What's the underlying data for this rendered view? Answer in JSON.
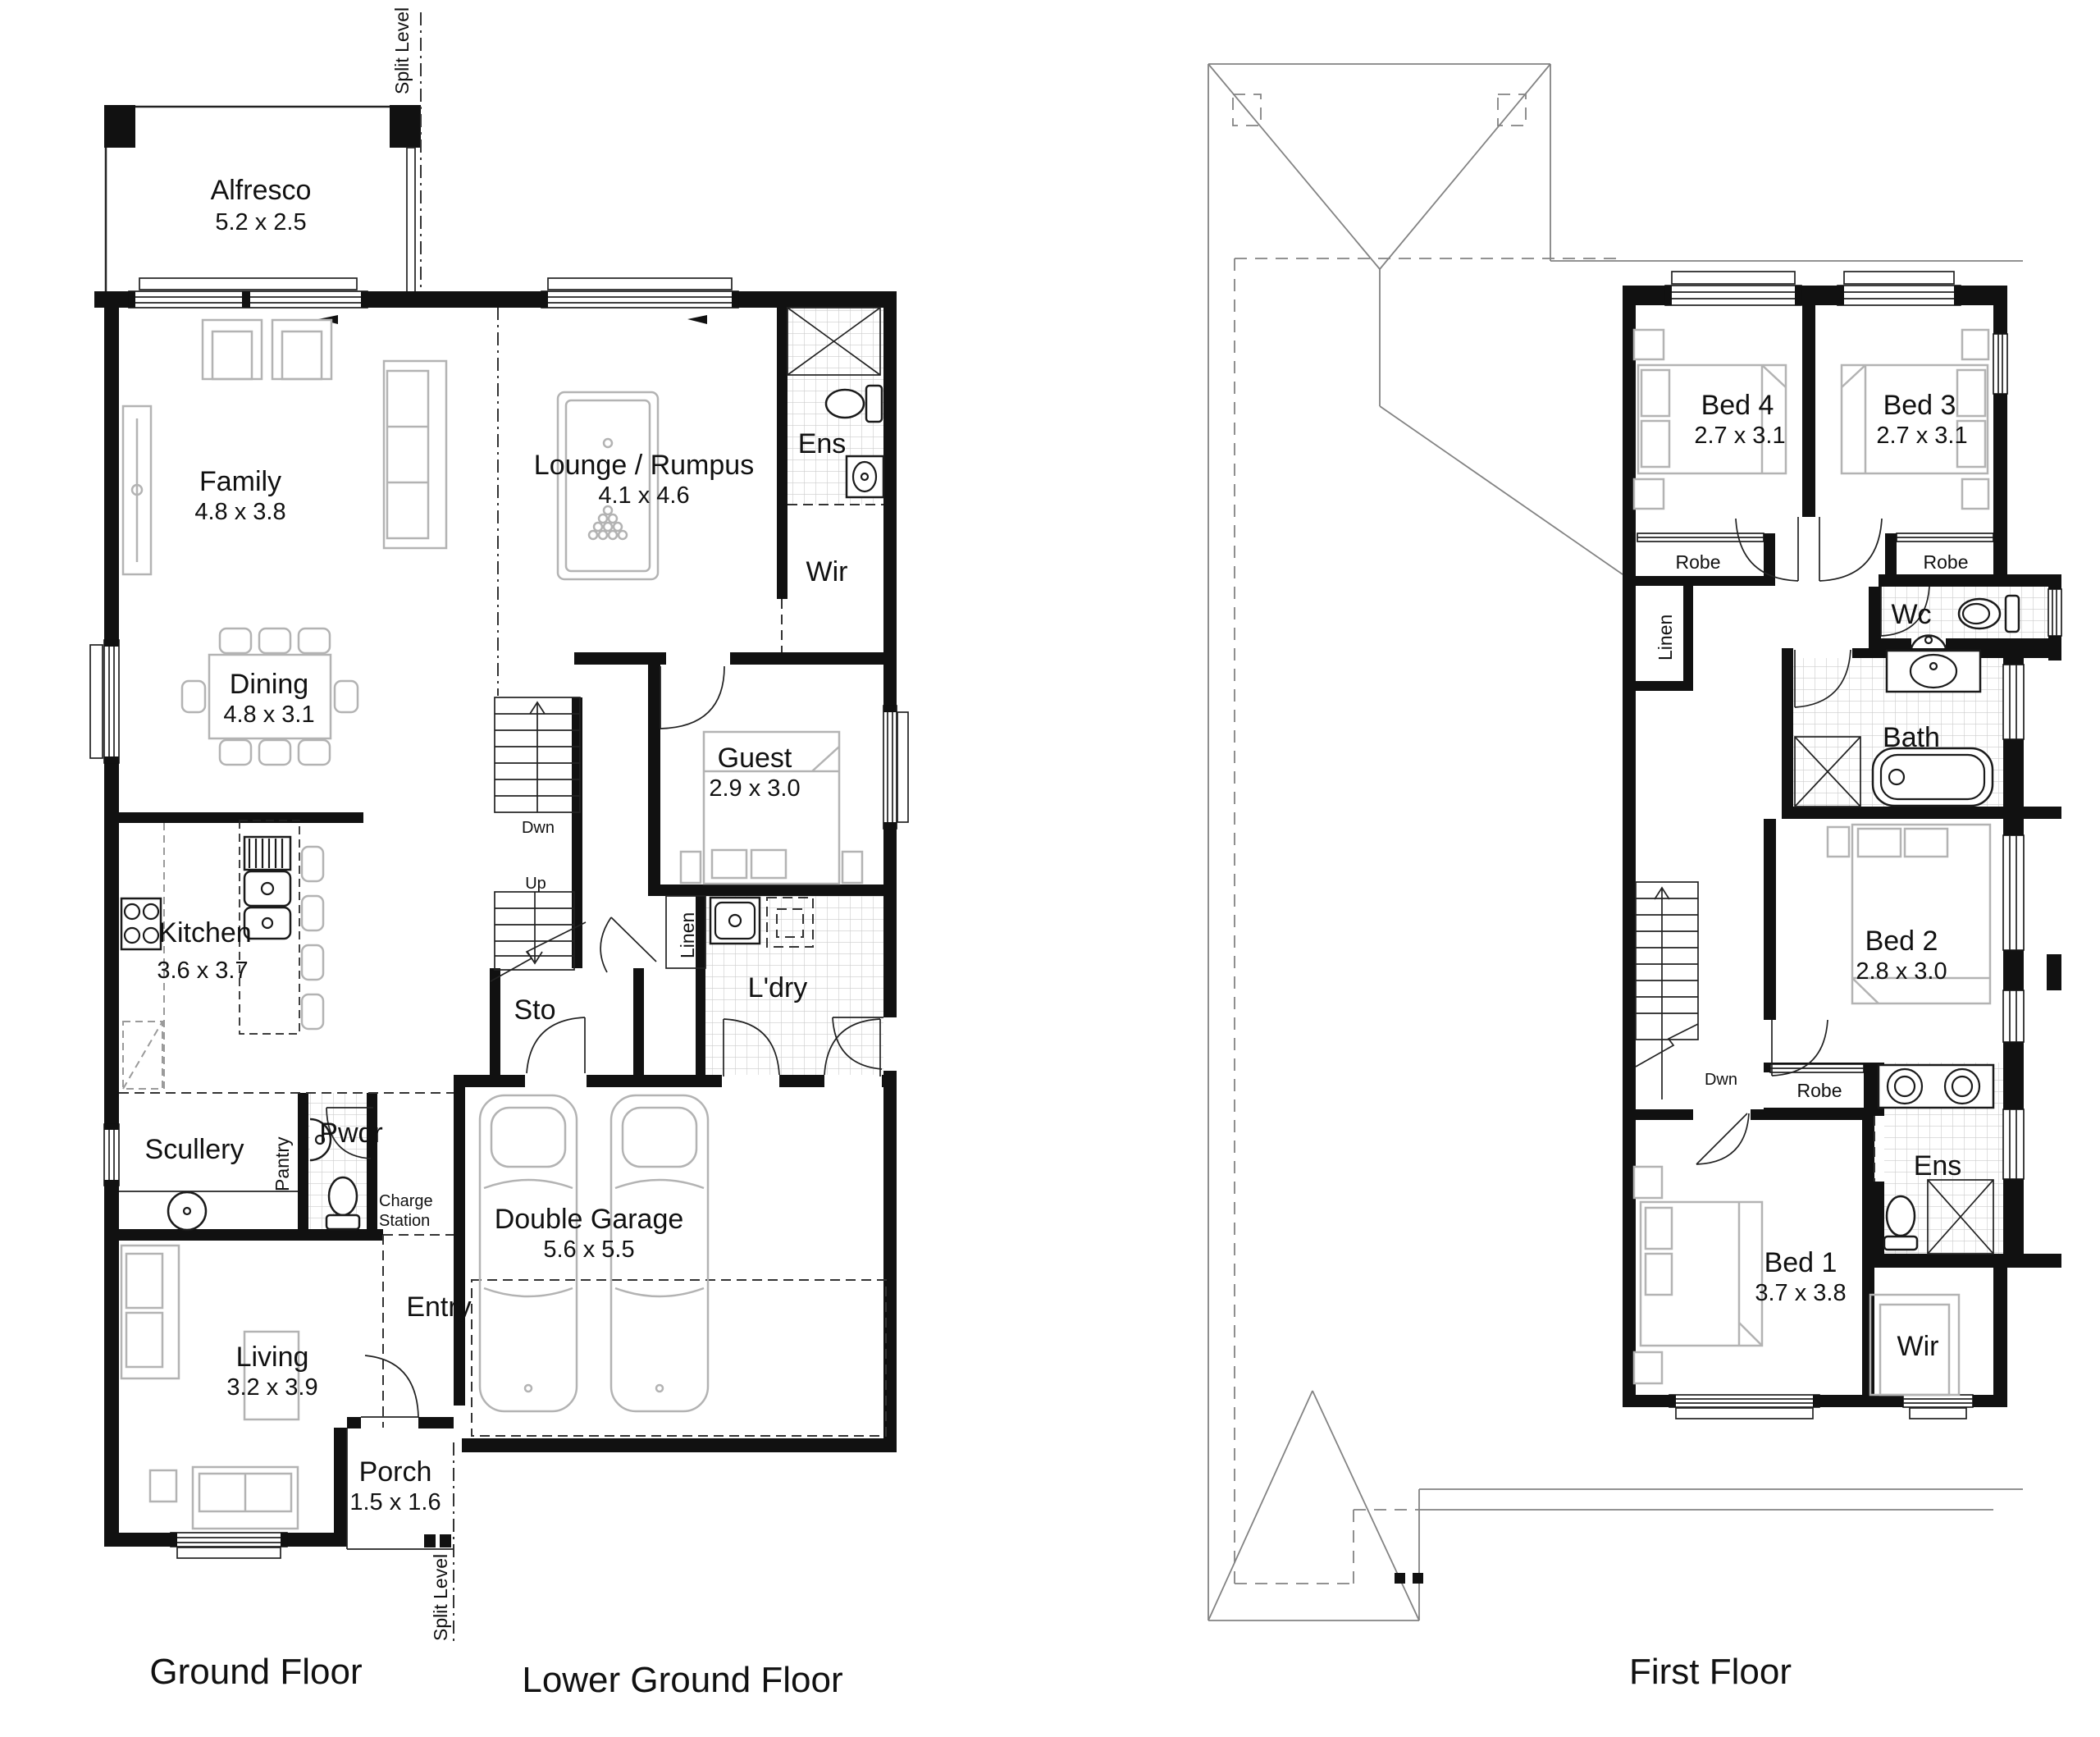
{
  "titles": {
    "ground": "Ground Floor",
    "lower_ground": "Lower Ground Floor",
    "first": "First Floor"
  },
  "misc": {
    "split_level": "Split Level"
  },
  "gf": {
    "alfresco": {
      "name": "Alfresco",
      "dims": "5.2 x 2.5"
    },
    "family": {
      "name": "Family",
      "dims": "4.8 x 3.8"
    },
    "lounge": {
      "name": "Lounge / Rumpus",
      "dims": "4.1 x 4.6"
    },
    "ens": {
      "name": "Ens"
    },
    "wir": {
      "name": "Wir"
    },
    "dining": {
      "name": "Dining",
      "dims": "4.8 x 3.1"
    },
    "guest": {
      "name": "Guest",
      "dims": "2.9 x 3.0"
    },
    "kitchen": {
      "name": "Kitchen",
      "dims": "3.6 x 3.7"
    },
    "sto": {
      "name": "Sto"
    },
    "stairs": {
      "down": "Dwn",
      "up": "Up"
    },
    "linen": {
      "name": "Linen"
    },
    "laundry": {
      "name": "L'dry"
    },
    "scullery": {
      "name": "Scullery"
    },
    "pantry": {
      "name": "Pantry"
    },
    "powder": {
      "name": "Pwdr"
    },
    "charge_station": {
      "line1": "Charge",
      "line2": "Station"
    },
    "entry": {
      "name": "Entry"
    },
    "living": {
      "name": "Living",
      "dims": "3.2 x 3.9"
    },
    "porch": {
      "name": "Porch",
      "dims": "1.5 x 1.6"
    },
    "garage": {
      "name": "Double Garage",
      "dims": "5.6 x 5.5"
    }
  },
  "ff": {
    "bed4": {
      "name": "Bed 4",
      "dims": "2.7 x 3.1"
    },
    "bed3": {
      "name": "Bed 3",
      "dims": "2.7 x 3.1"
    },
    "robe_bed4": {
      "name": "Robe"
    },
    "robe_bed3": {
      "name": "Robe"
    },
    "linen": {
      "name": "Linen"
    },
    "wc": {
      "name": "Wc"
    },
    "bath": {
      "name": "Bath"
    },
    "bed2": {
      "name": "Bed 2",
      "dims": "2.8 x 3.0"
    },
    "stairs": {
      "down": "Dwn"
    },
    "robe_bed1": {
      "name": "Robe"
    },
    "ens": {
      "name": "Ens"
    },
    "bed1": {
      "name": "Bed 1",
      "dims": "3.7 x 3.8"
    },
    "wir": {
      "name": "Wir"
    }
  },
  "colors": {
    "wall": "#111111",
    "fixture": "#1a1a1a",
    "furniture": "#b3b3b3",
    "tile_line": "#cccccc",
    "roof_line": "#808080",
    "background": "#ffffff"
  }
}
